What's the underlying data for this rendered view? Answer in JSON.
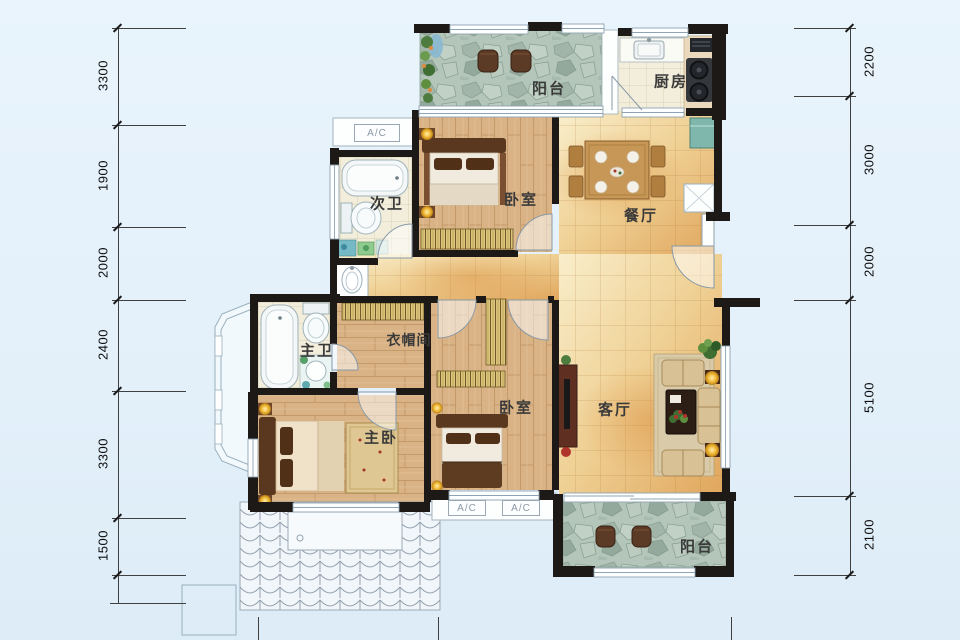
{
  "rooms": {
    "balcony_top": "阳台",
    "kitchen": "厨房",
    "bath_second": "次卫",
    "bedroom_top": "卧室",
    "dining": "餐厅",
    "bath_master": "主卫",
    "cloakroom": "衣帽间",
    "bedroom_master": "主卧",
    "bedroom_second": "卧室",
    "living": "客厅",
    "balcony_bottom": "阳台"
  },
  "ac": [
    "A/C",
    "A/C",
    "A/C"
  ],
  "dimensions": {
    "left": [
      "3300",
      "1900",
      "2000",
      "2400",
      "3300",
      "1500"
    ],
    "right": [
      "2200",
      "3000",
      "2000",
      "5100",
      "2100"
    ]
  },
  "colors": {
    "background": "#e9f4fc",
    "wall": "#1d1916",
    "wood_floor": "#d9b286",
    "warm_tile": "#eccb90",
    "cream_tile": "#f3eedb",
    "stone_tile": "#b4c5ba",
    "wardrobe_gold": "#dcc47c",
    "dark_wood": "#5a3820",
    "annotation": "#3f3f3f"
  }
}
